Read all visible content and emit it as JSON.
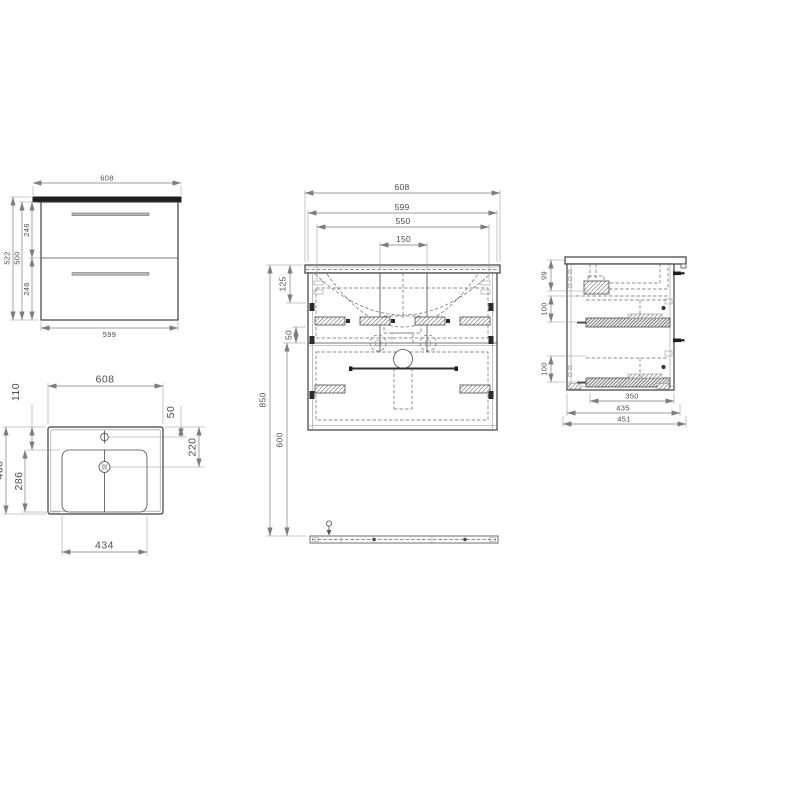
{
  "drawing": {
    "title": "vanity-unit-dimension-drawing",
    "line_color": "#3d3d3d",
    "dim_color": "#7d7d7d",
    "countertop_color": "#1e1e1e",
    "handle_color": "#b9b9b9"
  },
  "views": {
    "front": {
      "label": "cabinet-front-view",
      "dims": {
        "top_width": "608",
        "bottom_width": "599",
        "overall_height": "522",
        "carcass_height": "500",
        "upper_drawer_height": "246",
        "lower_drawer_height": "246"
      }
    },
    "plan": {
      "label": "basin-plan-view",
      "dims": {
        "width": "608",
        "depth": "460",
        "rim_to_bowl": "110",
        "faucet_offset": "50",
        "drain_offset": "220",
        "bowl_depth": "286",
        "bowl_width": "434"
      }
    },
    "section_front": {
      "label": "front-section-view",
      "dims": {
        "top_width": "608",
        "carcass_width": "599",
        "hanger_span": "550",
        "drain_span": "150",
        "wall_height": "850",
        "top_offset": "125",
        "slide_offset": "50",
        "rail_drop": "600"
      }
    },
    "section_side": {
      "label": "side-section-view",
      "dims": {
        "basin_depth": "99",
        "upper_slide_drop": "100",
        "lower_slide_drop": "100",
        "drawer_depth": "350",
        "carcass_depth": "435",
        "overall_depth": "451"
      }
    }
  }
}
